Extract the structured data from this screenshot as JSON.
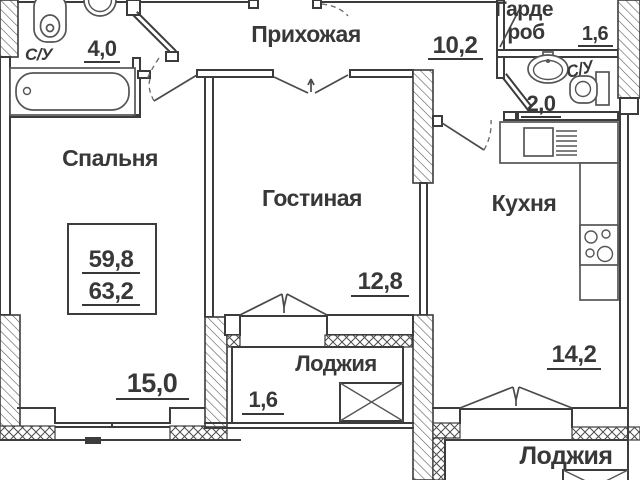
{
  "colors": {
    "line": "#3c3c3c",
    "text": "#383838"
  },
  "plan": {
    "total_area": {
      "top": "59,8",
      "bottom": "63,2"
    },
    "rooms": {
      "hallway": {
        "name": "Прихожая",
        "area": "10,2"
      },
      "bathroom_main": {
        "name": "С/У",
        "area": "4,0"
      },
      "bedroom": {
        "name": "Спальня",
        "area": "15,0"
      },
      "living_room": {
        "name": "Гостиная",
        "area": "12,8"
      },
      "kitchen": {
        "name": "Кухня",
        "area": "14,2"
      },
      "wardrobe": {
        "name_line1": "Гарде",
        "name_line2": "роб",
        "area": "1,6"
      },
      "bathroom_small": {
        "name": "С/У",
        "area": "2,0"
      },
      "loggia_center": {
        "name": "Лоджия",
        "area": "1,6"
      },
      "loggia_right": {
        "name": "Лоджия"
      }
    }
  }
}
